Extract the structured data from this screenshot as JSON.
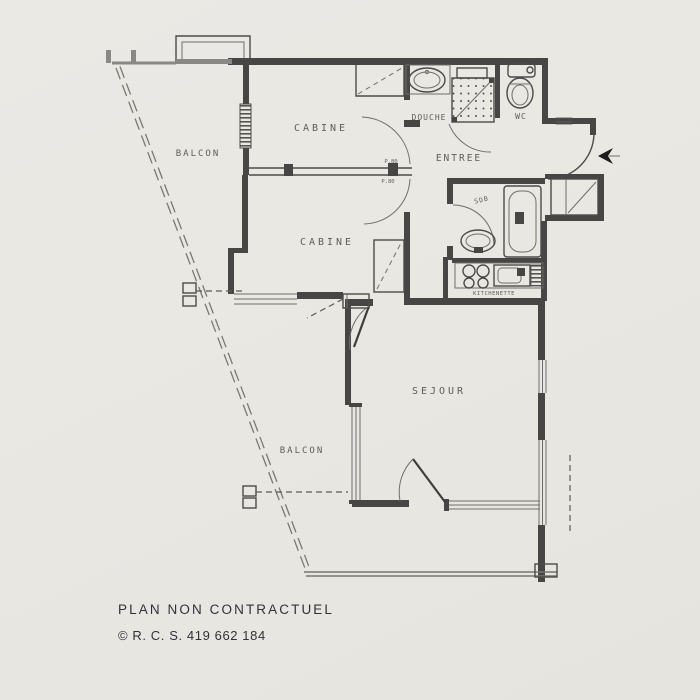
{
  "meta": {
    "background_color": "#e9e7e2",
    "wall_ink_color": "#474645",
    "label_ink_color": "#52524e",
    "footer_ink_color": "#31313a"
  },
  "rooms": {
    "balcon_top": "BALCON",
    "cabine_1": "CABINE",
    "douche": "DOUCHE",
    "wc": "WC",
    "entree": "ENTREE",
    "cabine_2": "CABINE",
    "sdb": "SDB",
    "kitchenette": "KITCHENETTE",
    "sejour": "SEJOUR",
    "balcon_bottom": "BALCON"
  },
  "annotations": {
    "door_width_top": "P.80",
    "door_width_bottom": "P.80"
  },
  "footer": {
    "line1": "PLAN NON CONTRACTUEL",
    "line2": "© R. C. S. 419 662 184"
  }
}
